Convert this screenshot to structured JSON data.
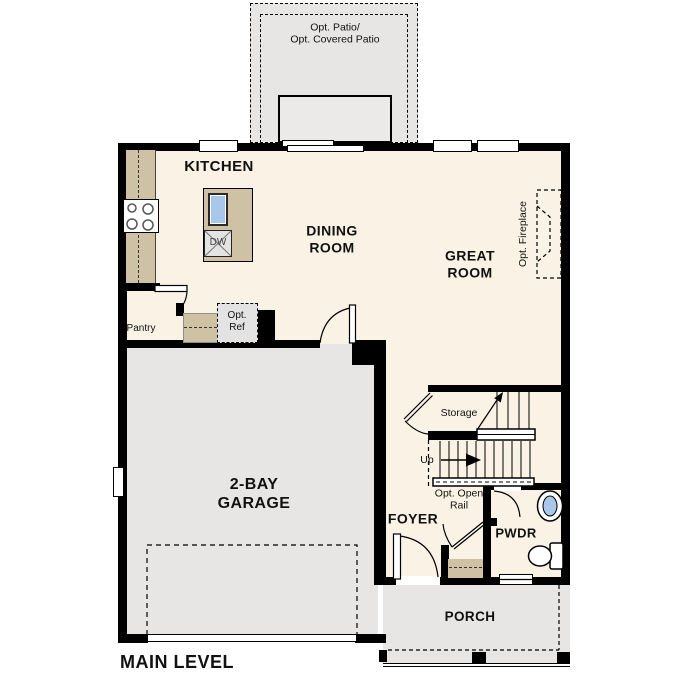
{
  "plan": {
    "title": "MAIN LEVEL"
  },
  "colors": {
    "floor": "#faf2e4",
    "concrete": "#e7e6e4",
    "wall": "#000000",
    "counter": "#cfc1a4",
    "fixture_blue": "#a9c8e9"
  },
  "patio": {
    "label": "Opt. Patio/\nOpt. Covered Patio"
  },
  "kitchen": {
    "label": "KITCHEN",
    "pantry_label": "Pantry",
    "dishwasher_label": "DW",
    "opt_ref_label": "Opt.\nRef"
  },
  "dining_room": {
    "label": "DINING\nROOM"
  },
  "great_room": {
    "label": "GREAT\nROOM",
    "fireplace_label": "Opt. Fireplace"
  },
  "stairs": {
    "storage_label": "Storage",
    "up_label": "Up",
    "open_rail_label": "Opt. Open\nRail"
  },
  "garage": {
    "label": "2-BAY\nGARAGE"
  },
  "foyer": {
    "label": "FOYER"
  },
  "powder_room": {
    "label": "PWDR"
  },
  "porch": {
    "label": "PORCH"
  }
}
